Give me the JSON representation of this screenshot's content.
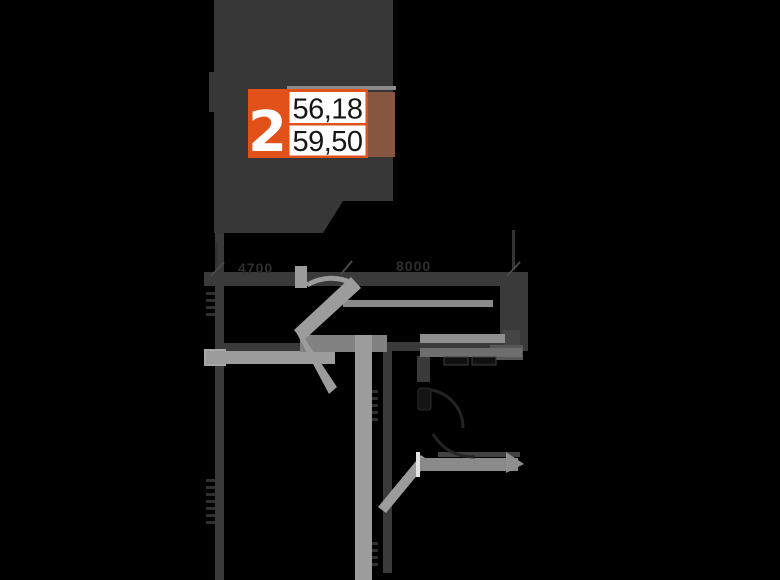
{
  "page": {
    "background": "#000000"
  },
  "apartment": {
    "badge": {
      "number": "2",
      "value_top": "56,18",
      "value_bottom": "59,50"
    },
    "colors": {
      "accent": "#e2511a",
      "tail": "#875640",
      "silhouette": "#373737",
      "value_text": "#161616",
      "number_text": "#ffffff"
    }
  },
  "floorplan": {
    "dimension_labels": [
      {
        "text": "4700"
      },
      {
        "text": "8000"
      }
    ],
    "colors": {
      "wall": "#3a3a3a",
      "light": "#9c9c9c",
      "dim_text": "#2f2f2f"
    }
  }
}
